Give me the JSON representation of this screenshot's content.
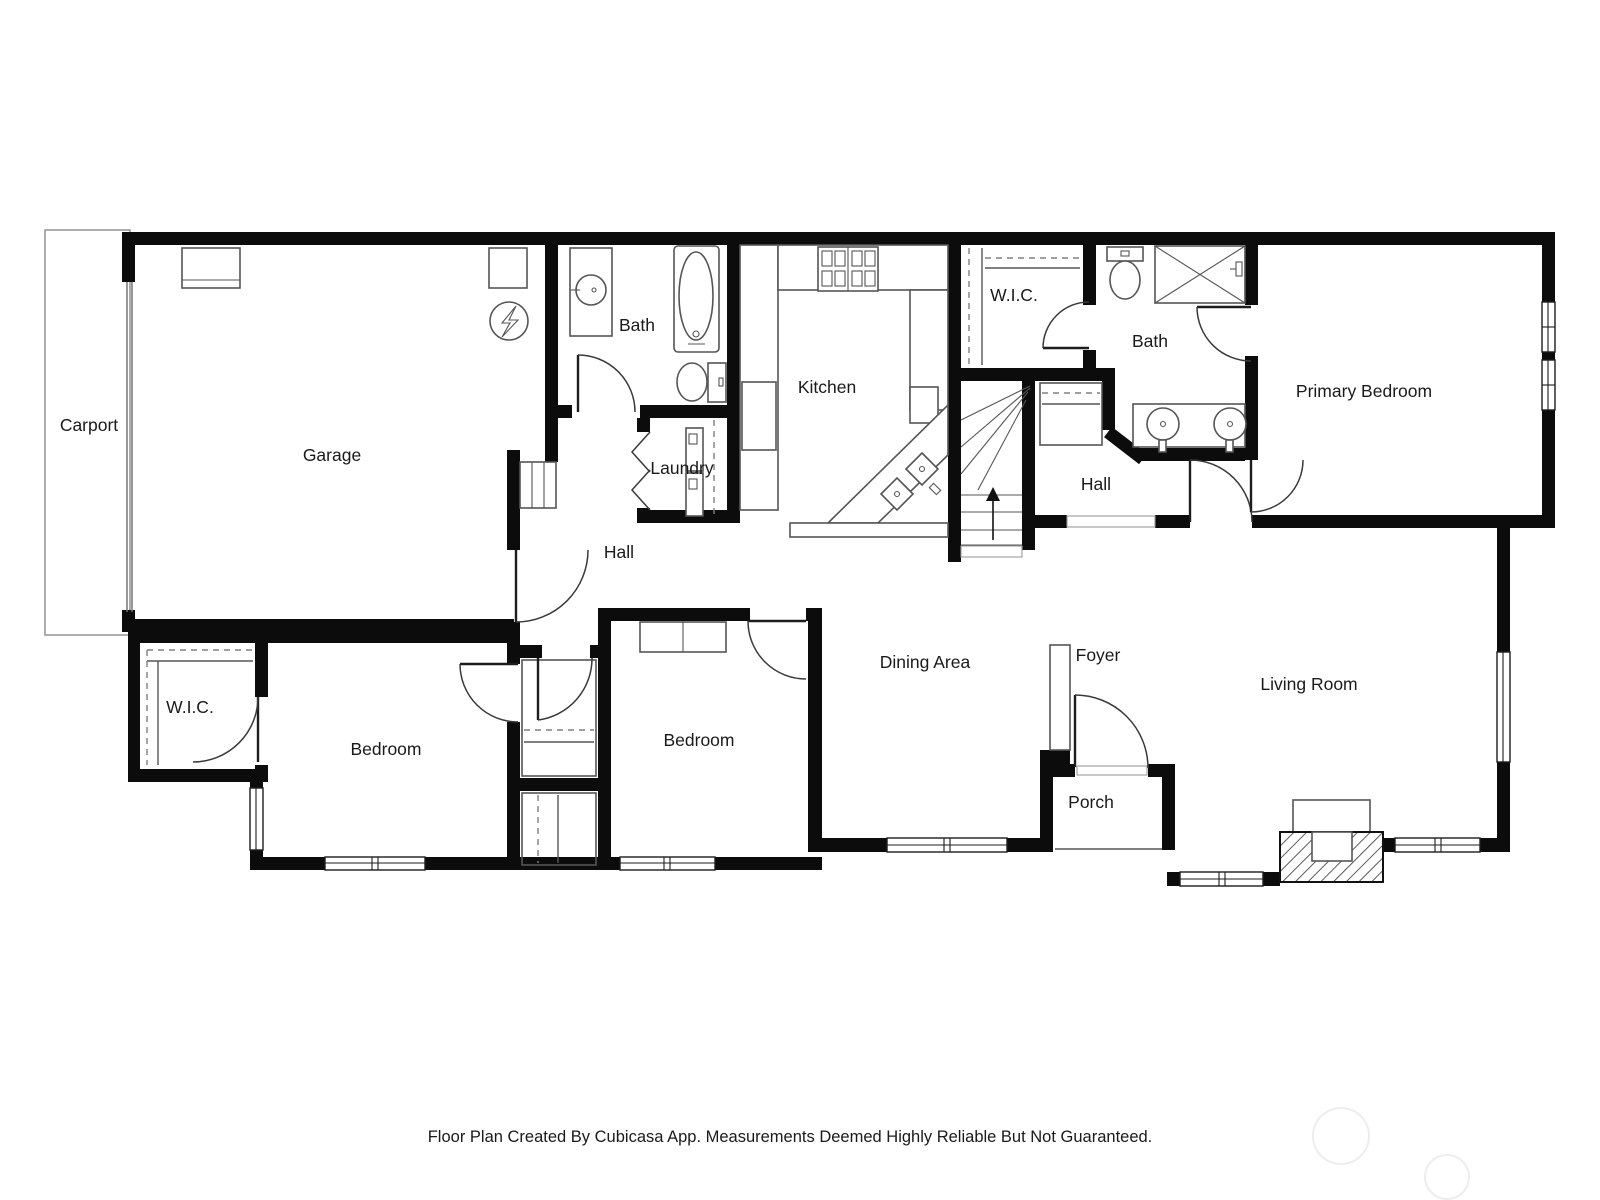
{
  "colors": {
    "wall": "#0c0c0c",
    "fixture": "#555555",
    "dashed": "#808080",
    "carport": "#9a9a9a",
    "watermark": "#ededed",
    "text": "#1a1a1a"
  },
  "rooms": [
    {
      "id": "carport",
      "label": "Carport"
    },
    {
      "id": "garage",
      "label": "Garage"
    },
    {
      "id": "bath-main",
      "label": "Bath"
    },
    {
      "id": "laundry",
      "label": "Laundry"
    },
    {
      "id": "hall-upper",
      "label": "Hall"
    },
    {
      "id": "kitchen",
      "label": "Kitchen"
    },
    {
      "id": "wic-primary",
      "label": "W.I.C."
    },
    {
      "id": "bath-primary",
      "label": "Bath"
    },
    {
      "id": "primary-bedroom",
      "label": "Primary Bedroom"
    },
    {
      "id": "hall-primary",
      "label": "Hall"
    },
    {
      "id": "wic-bedroom",
      "label": "W.I.C."
    },
    {
      "id": "bedroom-left",
      "label": "Bedroom"
    },
    {
      "id": "bedroom-middle",
      "label": "Bedroom"
    },
    {
      "id": "dining-area",
      "label": "Dining Area"
    },
    {
      "id": "foyer",
      "label": "Foyer"
    },
    {
      "id": "living-room",
      "label": "Living Room"
    },
    {
      "id": "porch",
      "label": "Porch"
    }
  ],
  "footer": {
    "text": "Floor Plan Created By Cubicasa App. Measurements Deemed Highly Reliable But Not Guaranteed."
  }
}
